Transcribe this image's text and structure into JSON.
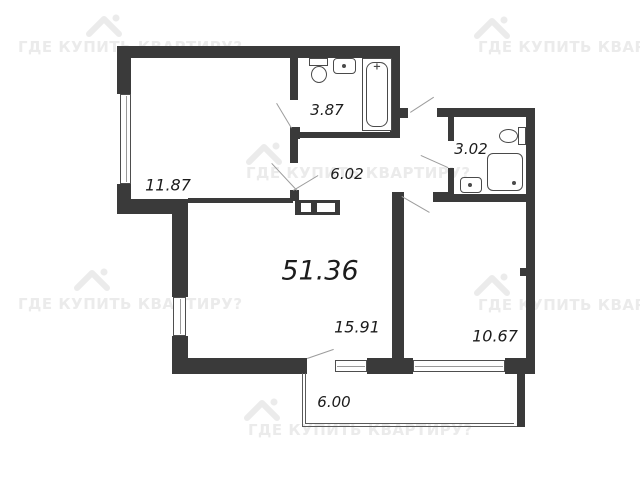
{
  "watermark": {
    "text": "ГДЕ КУПИТЬ КВАРТИРУ?",
    "icon": "house-icon",
    "color": "#ebebeb"
  },
  "plan": {
    "total_area": "51.36",
    "rooms": [
      {
        "name": "room-top-left",
        "area": "11.87"
      },
      {
        "name": "bathroom-top",
        "area": "3.87"
      },
      {
        "name": "hallway",
        "area": "6.02"
      },
      {
        "name": "bathroom-right",
        "area": "3.02"
      },
      {
        "name": "living-room",
        "area": "15.91"
      },
      {
        "name": "bedroom",
        "area": "10.67"
      },
      {
        "name": "balcony",
        "area": "6.00"
      }
    ],
    "fixtures": [
      "toilet",
      "sink",
      "bathtub",
      "toilet",
      "shower",
      "sink",
      "wardrobe"
    ],
    "colors": {
      "wall": "#3a3a3a",
      "fixture_line": "#4a4a4a",
      "label": "#1c1c1c",
      "door_line": "#9c9c9c",
      "background": "#ffffff"
    }
  }
}
